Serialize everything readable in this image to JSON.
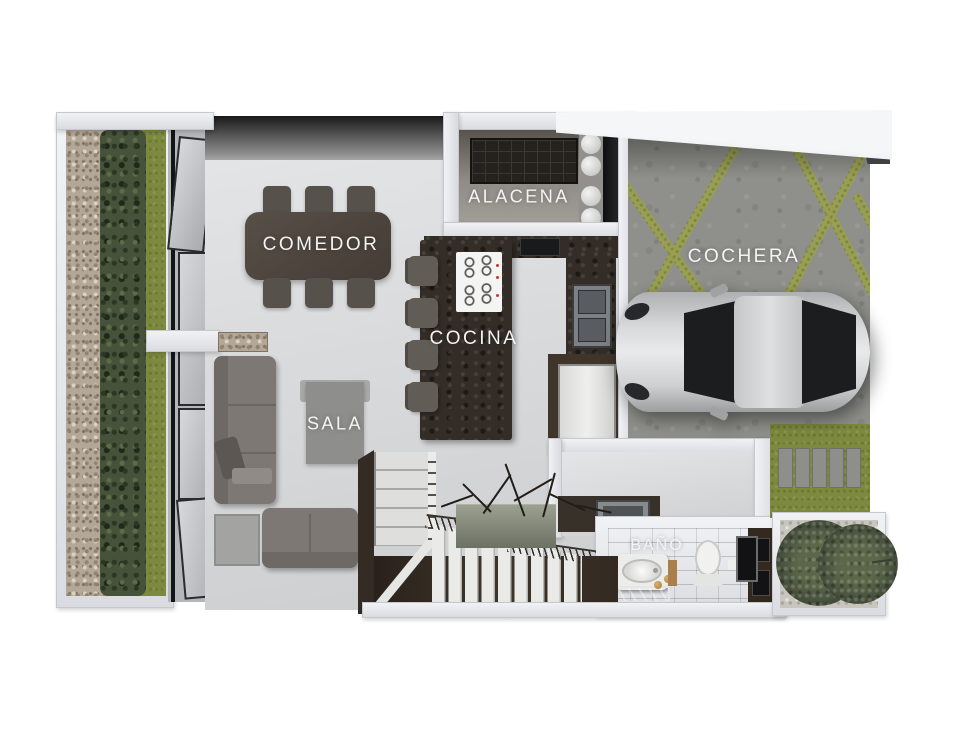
{
  "scene": {
    "type": "3d-floor-plan-render",
    "background": "#ffffff"
  },
  "rooms": {
    "comedor": {
      "label": "COMEDOR"
    },
    "alacena": {
      "label": "ALACENA"
    },
    "cocina": {
      "label": "COCINA"
    },
    "cochera": {
      "label": "COCHERA"
    },
    "sala": {
      "label": "SALA"
    },
    "bano": {
      "label": "BAÑO"
    }
  },
  "palette": {
    "label_text": "#f3f3f3",
    "wall": "#e8eaee",
    "interior_floor": "#dcdde0",
    "kitchen_stone": "#342d27",
    "garage_concrete": "#8f908b",
    "garage_stripe": "#9aa04f",
    "grass": "#7d8a3e",
    "hedge": "#46523a",
    "gravel": "#b3a795",
    "bathroom_tile": "#4e3d2f",
    "sofa": "#7d7873",
    "dining_table": "#4b433c",
    "car_body": "#c9cacc",
    "car_glass": "#1b1d1f"
  }
}
